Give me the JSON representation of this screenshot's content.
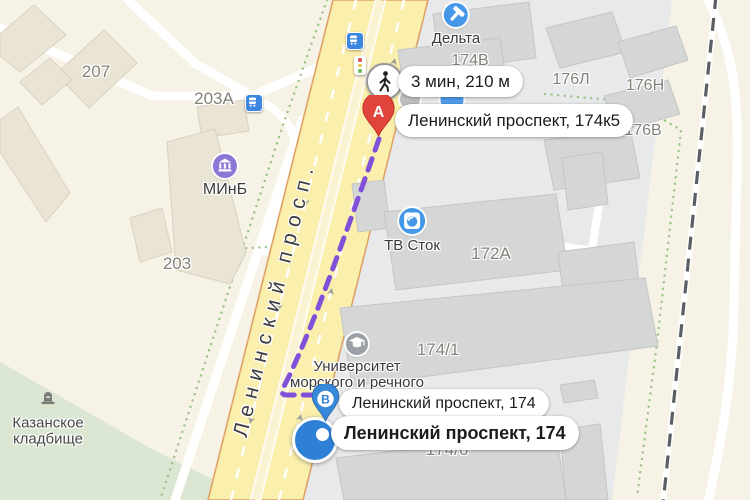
{
  "colors": {
    "route_purple": "#8051d8",
    "marker_a_red": "#e0443a",
    "marker_b_blue": "#3788d8",
    "selected_marker_blue": "#2e7fd6",
    "poi_blue": "#4598e8",
    "poi_purple": "#8d76d6",
    "poi_gray": "#9aa0a6",
    "road_yellow": "#faefad"
  },
  "street": {
    "name": "Ленинский просп."
  },
  "route": {
    "badge_text": "3 мин, 210 м",
    "badge_icon": "pedestrian-icon",
    "point_a": {
      "letter": "А",
      "address": "Ленинский проспект, 174к5"
    },
    "point_b": {
      "letter": "В",
      "address": "Ленинский проспект, 174"
    },
    "selected_address": "Ленинский проспект, 174"
  },
  "pois": {
    "delta": {
      "name": "Дельта",
      "icon": "hammer-icon"
    },
    "minb": {
      "name": "МИнБ",
      "icon": "bank-icon"
    },
    "tv_stok": {
      "name": "ТВ Сток",
      "icon": "washer-icon"
    },
    "university": {
      "name": "Университет морского и речного",
      "icon": "graduation-cap-icon"
    },
    "cemetery": {
      "name": "Казанское кладбище",
      "icon": "tombstone-icon"
    }
  },
  "buildings": {
    "b207": "207",
    "b203a": "203А",
    "b203": "203",
    "b174v": "174В",
    "b176l": "176Л",
    "b176n": "176Н",
    "b176v": "176В",
    "b172a": "172А",
    "b174_1": "174/1",
    "b174_6": "174/6"
  }
}
